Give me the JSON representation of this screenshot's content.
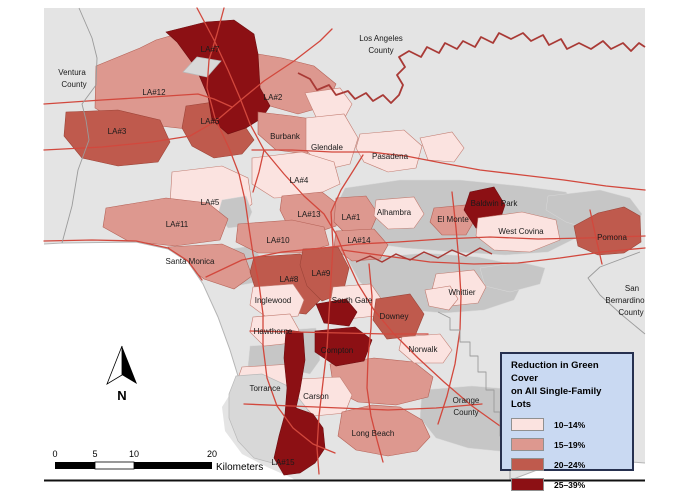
{
  "legend": {
    "title_line1": "Reduction in Green Cover",
    "title_line2": "on All Single-Family Lots",
    "classes": [
      {
        "label": "10–14%",
        "color": "#fbe3e0"
      },
      {
        "label": "15–19%",
        "color": "#dd988f"
      },
      {
        "label": "20–24%",
        "color": "#bf5a4d"
      },
      {
        "label": "25–39%",
        "color": "#8c1014"
      }
    ]
  },
  "scale_bar": {
    "ticks": [
      "0",
      "5",
      "10",
      "20"
    ],
    "unit": "Kilometers"
  },
  "north_arrow": {
    "label": "N"
  },
  "colors": {
    "q1": "#fbe3e0",
    "q2": "#dd988f",
    "q3": "#bf5a4d",
    "q4": "#8c1014",
    "map_bg": "#e4e4e4",
    "unclassified": "#c6c6c6",
    "unclassified_light": "#d8d8d8",
    "road": "#d2483d",
    "county_line": "#a93a36",
    "admin_line": "#9b9b9b",
    "ocean": "#ffffff",
    "legend_bg": "#c9d9f2",
    "legend_border": "#26304f",
    "text": "#1a1a1a"
  },
  "map": {
    "labels": [
      {
        "text": "Ventura",
        "x": 72,
        "y": 75,
        "size": 9
      },
      {
        "text": "County",
        "x": 74,
        "y": 87,
        "size": 9
      },
      {
        "text": "Los Angeles",
        "x": 381,
        "y": 41,
        "size": 9
      },
      {
        "text": "County",
        "x": 381,
        "y": 53,
        "size": 9
      },
      {
        "text": "LA#7",
        "x": 210,
        "y": 52
      },
      {
        "text": "LA#12",
        "x": 154,
        "y": 95
      },
      {
        "text": "LA#2",
        "x": 273,
        "y": 100
      },
      {
        "text": "LA#3",
        "x": 117,
        "y": 134
      },
      {
        "text": "LA#6",
        "x": 210,
        "y": 124
      },
      {
        "text": "Burbank",
        "x": 285,
        "y": 139
      },
      {
        "text": "Glendale",
        "x": 327,
        "y": 150
      },
      {
        "text": "Pasadena",
        "x": 390,
        "y": 159
      },
      {
        "text": "LA#4",
        "x": 299,
        "y": 183
      },
      {
        "text": "LA#5",
        "x": 210,
        "y": 205
      },
      {
        "text": "LA#13",
        "x": 309,
        "y": 217
      },
      {
        "text": "LA#1",
        "x": 351,
        "y": 220
      },
      {
        "text": "Alhambra",
        "x": 394,
        "y": 215
      },
      {
        "text": "El Monte",
        "x": 453,
        "y": 222
      },
      {
        "text": "Baldwin Park",
        "x": 494,
        "y": 206
      },
      {
        "text": "West Covina",
        "x": 521,
        "y": 234
      },
      {
        "text": "Pomona",
        "x": 612,
        "y": 240
      },
      {
        "text": "LA#11",
        "x": 177,
        "y": 227
      },
      {
        "text": "LA#10",
        "x": 278,
        "y": 243
      },
      {
        "text": "LA#14",
        "x": 359,
        "y": 243
      },
      {
        "text": "Santa Monica",
        "x": 190,
        "y": 264
      },
      {
        "text": "LA#8",
        "x": 289,
        "y": 282
      },
      {
        "text": "LA#9",
        "x": 321,
        "y": 276
      },
      {
        "text": "Inglewood",
        "x": 273,
        "y": 303
      },
      {
        "text": "South Gate",
        "x": 352,
        "y": 303
      },
      {
        "text": "Downey",
        "x": 394,
        "y": 319
      },
      {
        "text": "Whittier",
        "x": 462,
        "y": 295
      },
      {
        "text": "Hawthorne",
        "x": 273,
        "y": 334
      },
      {
        "text": "Compton",
        "x": 337,
        "y": 353
      },
      {
        "text": "Norwalk",
        "x": 423,
        "y": 352
      },
      {
        "text": "Torrance",
        "x": 265,
        "y": 391
      },
      {
        "text": "Carson",
        "x": 316,
        "y": 399
      },
      {
        "text": "Long Beach",
        "x": 373,
        "y": 436
      },
      {
        "text": "LA#15",
        "x": 283,
        "y": 465
      },
      {
        "text": "Orange",
        "x": 466,
        "y": 403,
        "size": 9
      },
      {
        "text": "County",
        "x": 466,
        "y": 415,
        "size": 9
      },
      {
        "text": "San",
        "x": 632,
        "y": 291,
        "size": 9
      },
      {
        "text": "Bernardino",
        "x": 625,
        "y": 303,
        "size": 9
      },
      {
        "text": "County",
        "x": 631,
        "y": 315,
        "size": 9
      }
    ],
    "areas": [
      {
        "name": "LA#1",
        "class": "15–19%"
      },
      {
        "name": "LA#2",
        "class": "15–19%"
      },
      {
        "name": "LA#3",
        "class": "20–24%"
      },
      {
        "name": "LA#4",
        "class": "10–14%"
      },
      {
        "name": "LA#5",
        "class": "10–14%"
      },
      {
        "name": "LA#6",
        "class": "20–24%"
      },
      {
        "name": "LA#7",
        "class": "25–39%"
      },
      {
        "name": "LA#8",
        "class": "20–24%"
      },
      {
        "name": "LA#9",
        "class": "20–24%"
      },
      {
        "name": "LA#10",
        "class": "15–19%"
      },
      {
        "name": "LA#11",
        "class": "15–19%"
      },
      {
        "name": "LA#12",
        "class": "15–19%"
      },
      {
        "name": "LA#13",
        "class": "15–19%"
      },
      {
        "name": "LA#14",
        "class": "15–19%"
      },
      {
        "name": "LA#15",
        "class": "25–39%"
      },
      {
        "name": "Burbank",
        "class": "15–19%"
      },
      {
        "name": "Glendale",
        "class": "10–14%"
      },
      {
        "name": "Pasadena",
        "class": "10–14%"
      },
      {
        "name": "Alhambra",
        "class": "10–14%"
      },
      {
        "name": "El Monte",
        "class": "15–19%"
      },
      {
        "name": "Baldwin Park",
        "class": "25–39%"
      },
      {
        "name": "West Covina",
        "class": "10–14%"
      },
      {
        "name": "Pomona",
        "class": "20–24%"
      },
      {
        "name": "Santa Monica",
        "class": "15–19%"
      },
      {
        "name": "Inglewood",
        "class": "10–14%"
      },
      {
        "name": "South Gate",
        "class": "10–14%"
      },
      {
        "name": "Downey",
        "class": "20–24%"
      },
      {
        "name": "Whittier",
        "class": "10–14%"
      },
      {
        "name": "Hawthorne",
        "class": "10–14%"
      },
      {
        "name": "Compton",
        "class": "25–39%"
      },
      {
        "name": "Norwalk",
        "class": "10–14%"
      },
      {
        "name": "Torrance",
        "class": "10–14%"
      },
      {
        "name": "Carson",
        "class": "10–14%"
      },
      {
        "name": "Long Beach",
        "class": "15–19%"
      }
    ]
  }
}
